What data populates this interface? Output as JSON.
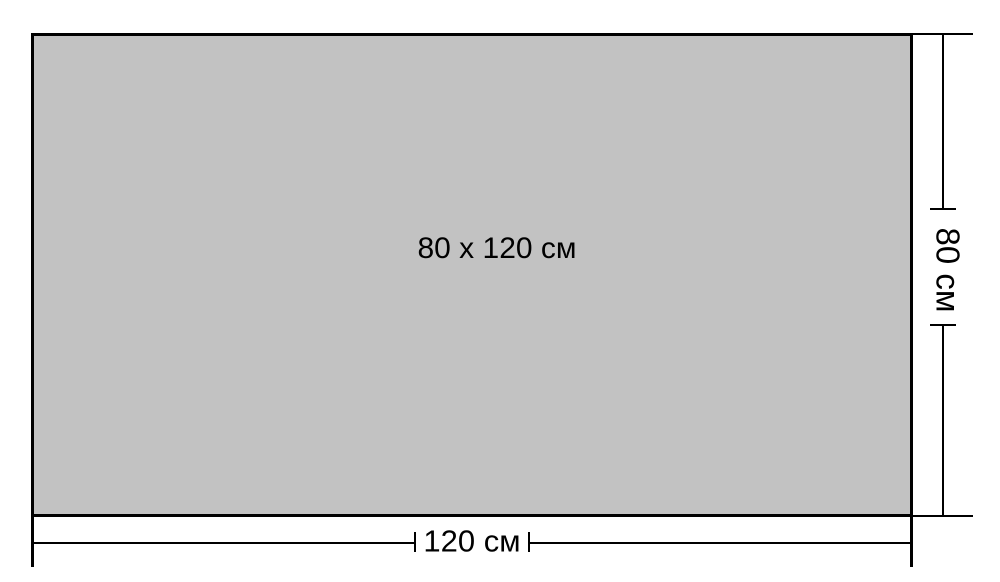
{
  "diagram": {
    "center_label": "80 x 120 см",
    "width_dimension": {
      "label": "120 см"
    },
    "height_dimension": {
      "label": "80 см"
    },
    "colors": {
      "rectangle_fill": "#c2c2c2",
      "line": "#000000",
      "background": "#ffffff"
    }
  }
}
